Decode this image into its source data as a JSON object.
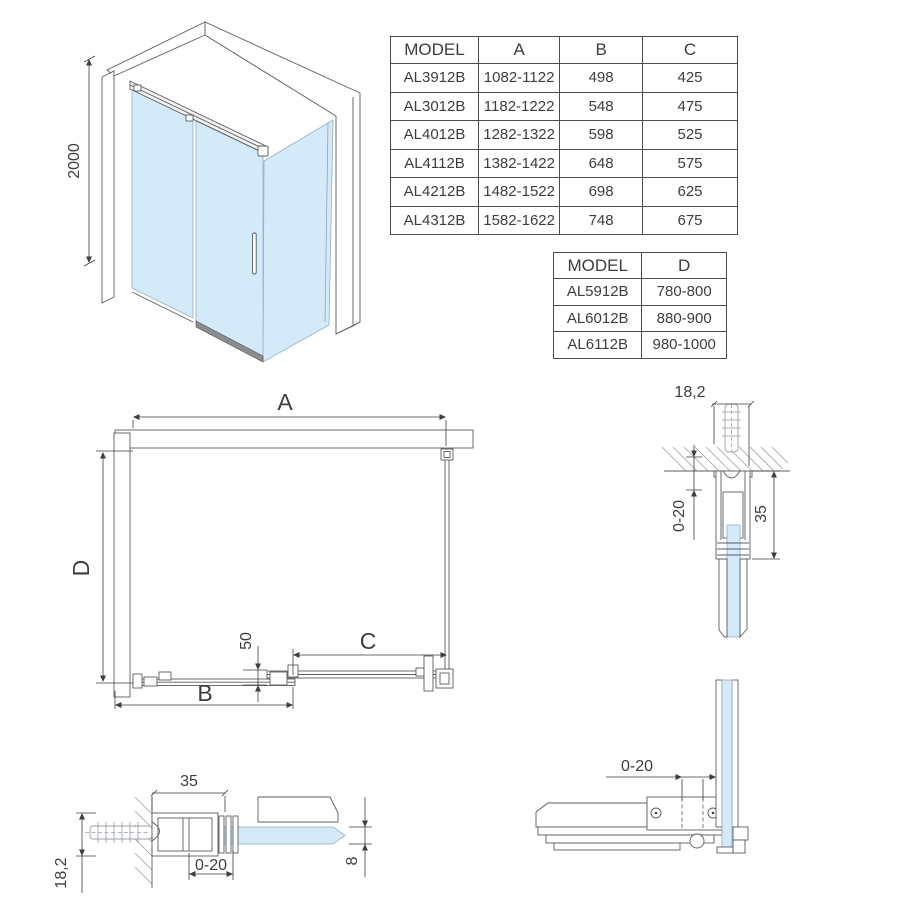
{
  "colors": {
    "glass": "#d5eaf8",
    "line": "#595c60",
    "dim_text": "#3d3d3d"
  },
  "iso": {
    "height_dim": "2000"
  },
  "plan": {
    "dim_a": "A",
    "dim_b": "B",
    "dim_c": "C",
    "dim_d": "D",
    "dim_overlap": "50"
  },
  "detail_wall_vertical": {
    "dim_width": "18,2",
    "dim_adjust": "0-20",
    "dim_height": "35"
  },
  "detail_wall_horizontal": {
    "dim_depth": "35",
    "dim_adjust": "0-20",
    "dim_glass": "8",
    "dim_width": "18,2"
  },
  "detail_corner": {
    "dim_adjust": "0-20"
  },
  "tables": {
    "main": {
      "headers": [
        "MODEL",
        "A",
        "B",
        "C"
      ],
      "rows": [
        [
          "AL3912B",
          "1082-1122",
          "498",
          "425"
        ],
        [
          "AL3012B",
          "1182-1222",
          "548",
          "475"
        ],
        [
          "AL4012B",
          "1282-1322",
          "598",
          "525"
        ],
        [
          "AL4112B",
          "1382-1422",
          "648",
          "575"
        ],
        [
          "AL4212B",
          "1482-1522",
          "698",
          "625"
        ],
        [
          "AL4312B",
          "1582-1622",
          "748",
          "675"
        ]
      ]
    },
    "depth": {
      "headers": [
        "MODEL",
        "D"
      ],
      "rows": [
        [
          "AL5912B",
          "780-800"
        ],
        [
          "AL6012B",
          "880-900"
        ],
        [
          "AL6112B",
          "980-1000"
        ]
      ]
    }
  }
}
